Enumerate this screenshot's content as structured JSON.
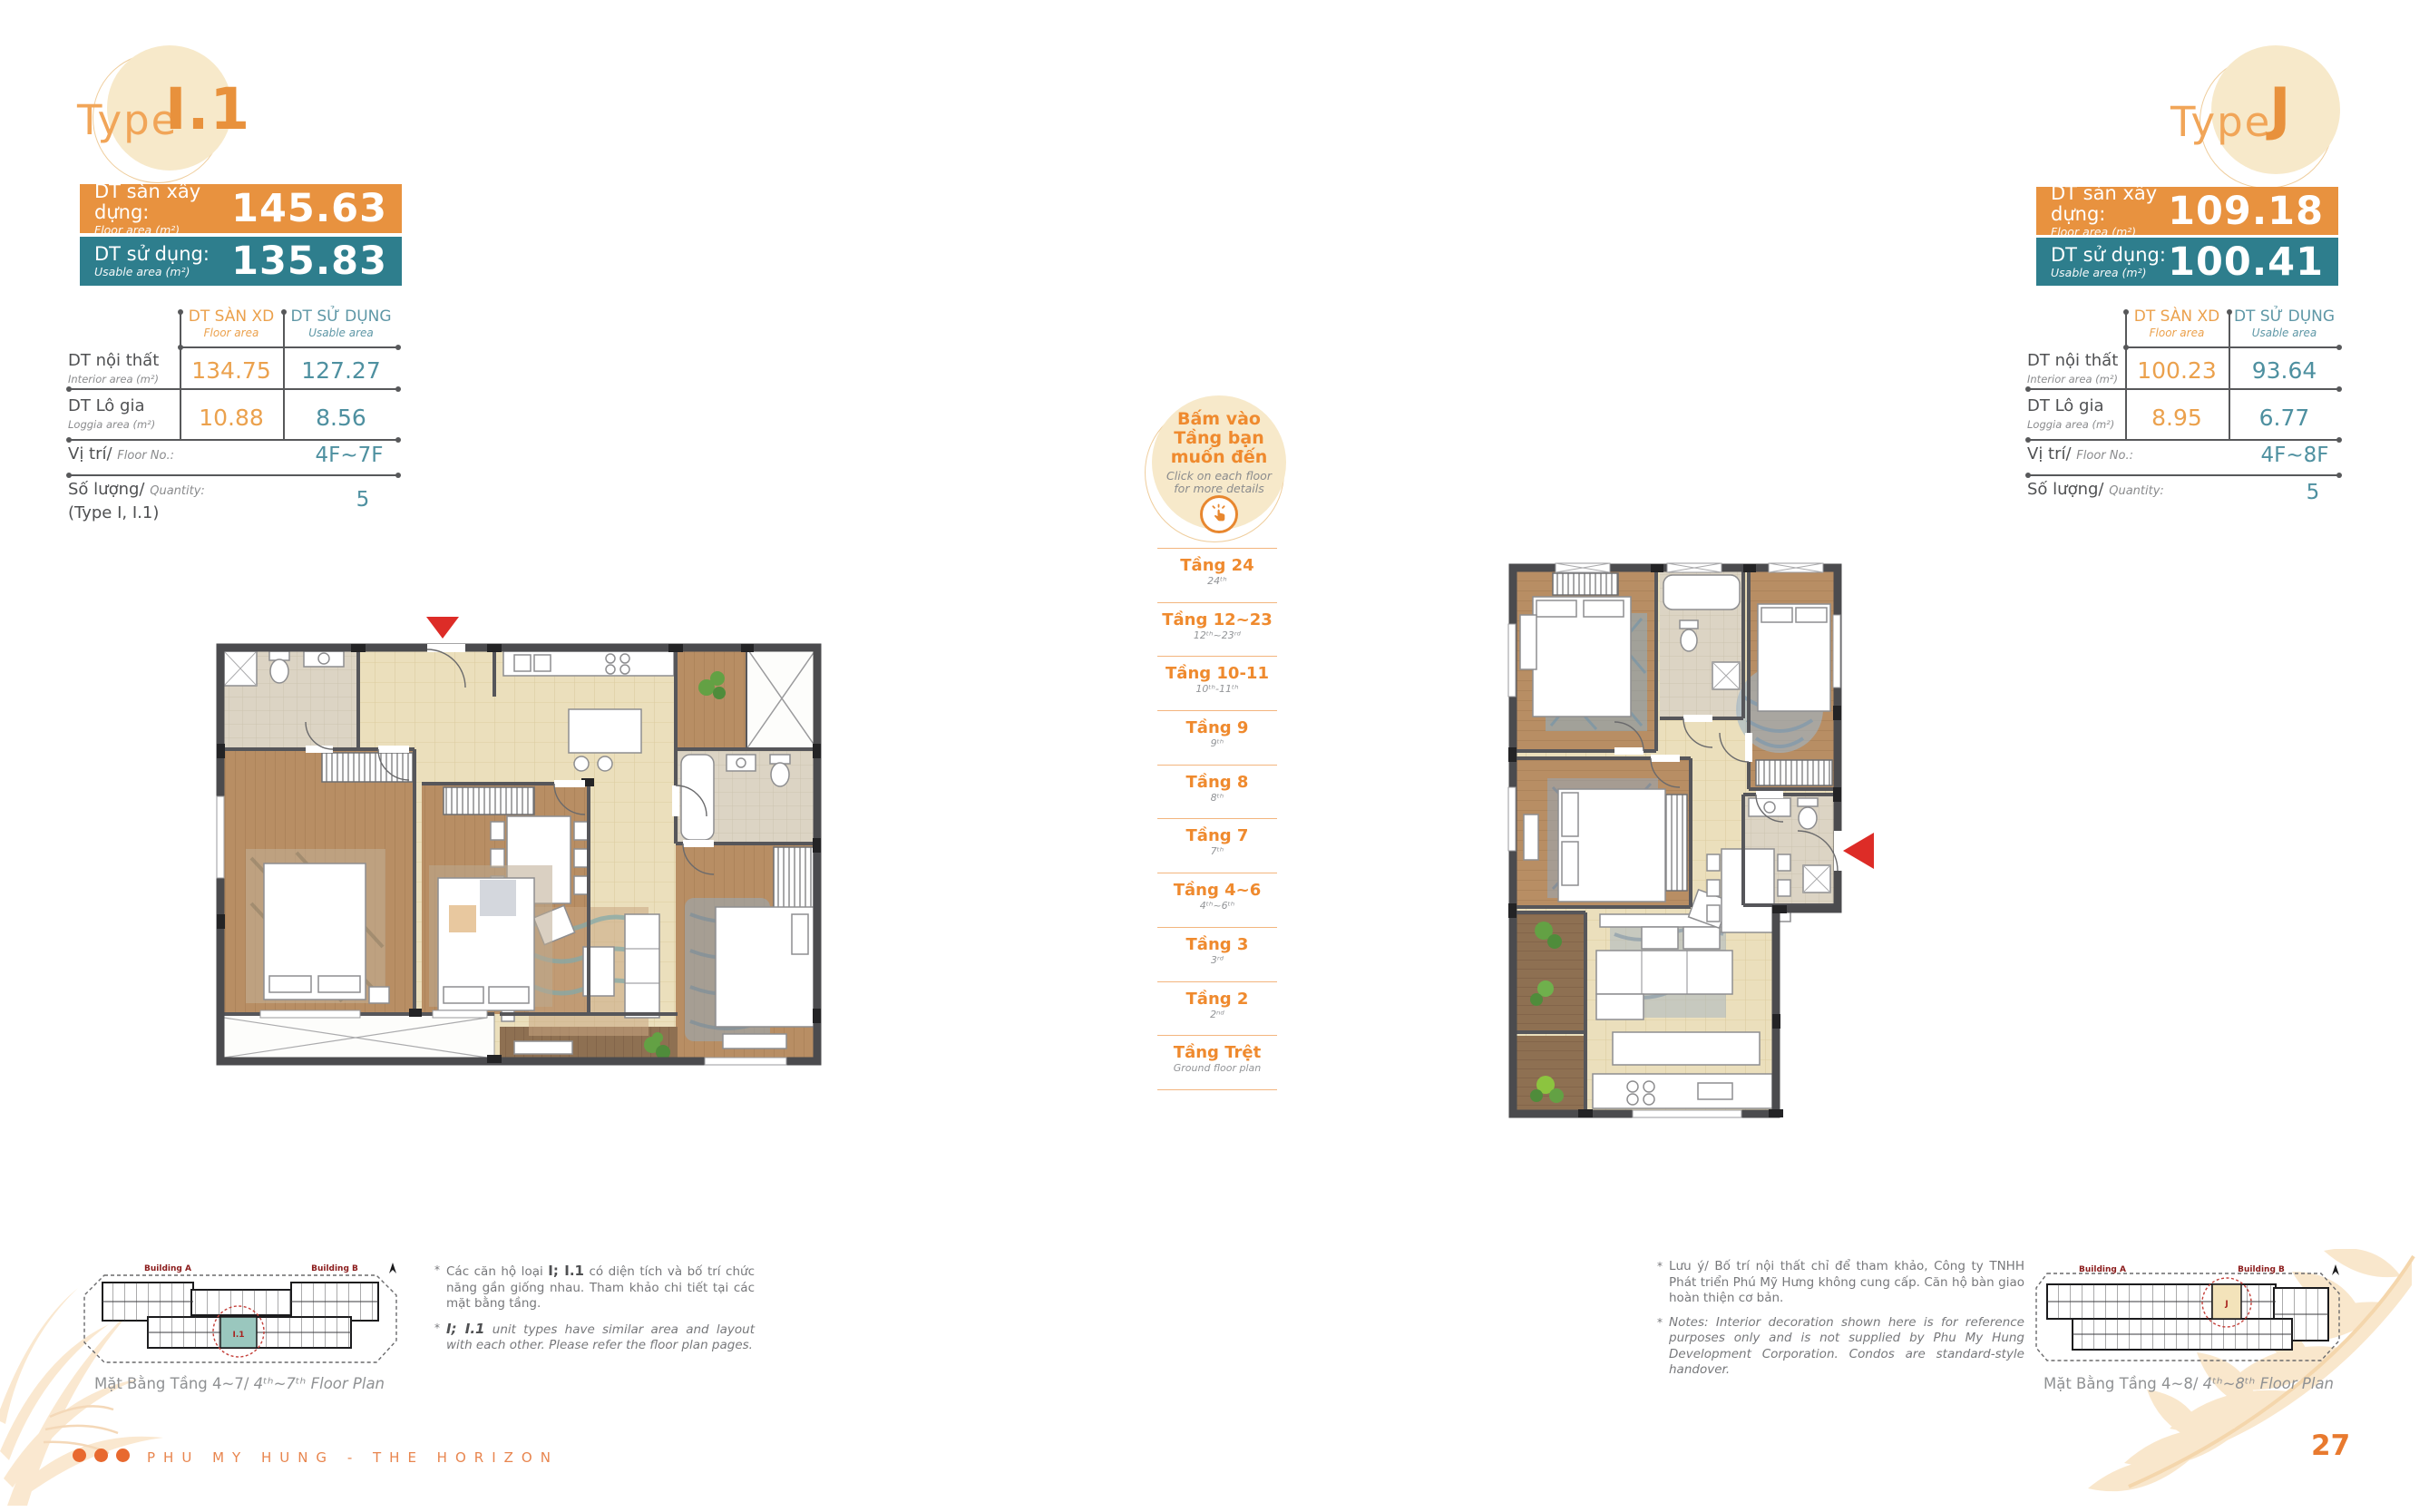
{
  "header_left": {
    "type_label": "Type",
    "type_name": "I.1"
  },
  "header_right": {
    "type_label": "Type",
    "type_name": "J"
  },
  "left_unit": {
    "floor_area": {
      "label_vn": "DT sàn xây dựng:",
      "label_en": "Floor area (m²)",
      "value": "145.63"
    },
    "usable_area": {
      "label_vn": "DT sử dụng:",
      "label_en": "Usable area (m²)",
      "value": "135.83"
    },
    "table": {
      "col_floor_vn": "DT SÀN XD",
      "col_floor_en": "Floor area",
      "col_usable_vn": "DT SỬ DỤNG",
      "col_usable_en": "Usable area",
      "rows": [
        {
          "label_vn": "DT nội thất",
          "label_en": "Interior area (m²)",
          "floor": "134.75",
          "usable": "127.27"
        },
        {
          "label_vn": "DT Lô gia",
          "label_en": "Loggia area (m²)",
          "floor": "10.88",
          "usable": "8.56"
        }
      ],
      "position_label_vn": "Vị trí/",
      "position_label_en": "Floor No.:",
      "position_value": "4F~7F",
      "quantity_label_vn": "Số lượng/",
      "quantity_label_en": "Quantity:",
      "quantity_note": "(Type I, I.1)",
      "quantity_value": "5"
    },
    "mini_caption_vn": "Mặt Bằng Tầng 4~7/ ",
    "mini_caption_en": "4ᵗʰ~7ᵗʰ Floor Plan",
    "building_a": "Building A",
    "building_b": "Building B",
    "mini_unit_tag": "I.1"
  },
  "right_unit": {
    "floor_area": {
      "label_vn": "DT sàn xây dựng:",
      "label_en": "Floor area (m²)",
      "value": "109.18"
    },
    "usable_area": {
      "label_vn": "DT sử dụng:",
      "label_en": "Usable area (m²)",
      "value": "100.41"
    },
    "table": {
      "col_floor_vn": "DT SÀN XD",
      "col_floor_en": "Floor area",
      "col_usable_vn": "DT SỬ DỤNG",
      "col_usable_en": "Usable area",
      "rows": [
        {
          "label_vn": "DT nội thất",
          "label_en": "Interior area (m²)",
          "floor": "100.23",
          "usable": "93.64"
        },
        {
          "label_vn": "DT Lô gia",
          "label_en": "Loggia area (m²)",
          "floor": "8.95",
          "usable": "6.77"
        }
      ],
      "position_label_vn": "Vị trí/",
      "position_label_en": "Floor No.:",
      "position_value": "4F~8F",
      "quantity_label_vn": "Số lượng/",
      "quantity_label_en": "Quantity:",
      "quantity_value": "5"
    },
    "mini_caption_vn": "Mặt Bằng Tầng 4~8/ ",
    "mini_caption_en": "4ᵗʰ~8ᵗʰ Floor Plan",
    "building_a": "Building A",
    "building_b": "Building B",
    "mini_unit_tag": "J"
  },
  "floor_selector": {
    "title_line1": "Bấm vào",
    "title_line2": "Tầng bạn",
    "title_line3": "muốn đến",
    "subtitle_line1": "Click on each floor",
    "subtitle_line2": "for more details",
    "floors": [
      {
        "vn": "Tầng 24",
        "en": "24ᵗʰ"
      },
      {
        "vn": "Tầng 12~23",
        "en": "12ᵗʰ~23ʳᵈ"
      },
      {
        "vn": "Tầng 10-11",
        "en": "10ᵗʰ-11ᵗʰ"
      },
      {
        "vn": "Tầng 9",
        "en": "9ᵗʰ"
      },
      {
        "vn": "Tầng 8",
        "en": "8ᵗʰ"
      },
      {
        "vn": "Tầng 7",
        "en": "7ᵗʰ"
      },
      {
        "vn": "Tầng 4~6",
        "en": "4ᵗʰ~6ᵗʰ"
      },
      {
        "vn": "Tầng 3",
        "en": "3ʳᵈ"
      },
      {
        "vn": "Tầng 2",
        "en": "2ⁿᵈ"
      },
      {
        "vn": "Tầng Trệt",
        "en": "Ground floor plan"
      }
    ]
  },
  "notes_left": {
    "bullet": "*",
    "vn_pre": "Các căn hộ loại ",
    "vn_bold": "I; I.1",
    "vn_post": " có diện tích và bố trí chức năng gần giống nhau. Tham khảo chi tiết tại các mặt bằng tầng.",
    "en_bold": "I; I.1",
    "en_post": " unit types have similar area and layout with each other. Please refer the floor plan pages."
  },
  "notes_right": {
    "bullet": "*",
    "vn": "Lưu ý/ Bố trí nội thất chỉ để tham khảo, Công ty TNHH Phát triển Phú Mỹ Hưng không cung cấp. Căn hộ bàn giao hoàn thiện cơ bản.",
    "en": "Notes: Interior decoration shown here is for reference purposes only and is not supplied by Phu My Hung Development Corporation. Condos are standard-style handover."
  },
  "footer": {
    "brand": "PHU MY HUNG - THE HORIZON",
    "page_number": "27"
  },
  "colors": {
    "accent_orange": "#E8913C",
    "accent_teal": "#2E7E8D",
    "floor_link_orange": "#EF8A2E",
    "highlight_red": "#DD2C27"
  }
}
